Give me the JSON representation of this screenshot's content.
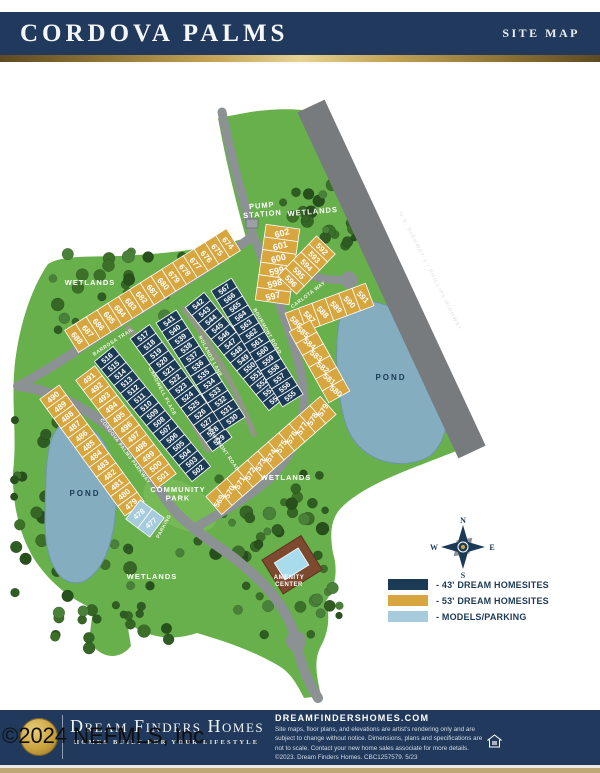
{
  "header": {
    "title": "CORDOVA PALMS",
    "right_label": "SITE MAP"
  },
  "legend": {
    "items": [
      {
        "label": "-  43' DREAM HOMESITES",
        "color": "#1b3a55"
      },
      {
        "label": "-  53' DREAM HOMESITES",
        "color": "#d8a63f"
      },
      {
        "label": "-  MODELS/PARKING",
        "color": "#a6cbdd"
      }
    ]
  },
  "compass": {
    "n": "N",
    "e": "E",
    "s": "S",
    "w": "W"
  },
  "map": {
    "colors": {
      "green": "#68b04c",
      "parkGreen": "#79bd58",
      "pond": "#84adc0",
      "pondEdge": "#6d96aa",
      "highway": "#777b7e",
      "road": "#8c9194",
      "lane": "#8e9883",
      "navy": "#1b3a55",
      "gold": "#d8a63f",
      "blue": "#a6cbdd",
      "lotStroke": "#ffffff"
    },
    "strips": [
      {
        "group": "navy",
        "numbers": [
          516,
          515,
          514,
          513,
          512,
          511,
          510,
          509,
          508,
          507,
          506,
          505,
          504,
          503,
          502
        ],
        "x1": 107,
        "y1": 358,
        "x2": 198,
        "y2": 470,
        "depth": 24,
        "numRot": -40,
        "fs": 7.5
      },
      {
        "group": "navy",
        "numbers": [
          517,
          518,
          519,
          520,
          521,
          522,
          523,
          524,
          525,
          526,
          527,
          528,
          529
        ],
        "x1": 143,
        "y1": 336,
        "x2": 219,
        "y2": 440,
        "depth": 24,
        "numRot": -40,
        "fs": 7.5
      },
      {
        "group": "navy",
        "numbers": [
          541,
          540,
          539,
          538,
          537,
          536,
          535,
          534,
          533,
          532,
          531,
          530
        ],
        "x1": 169,
        "y1": 321,
        "x2": 232,
        "y2": 419,
        "depth": 24,
        "numRot": -40,
        "fs": 7.5
      },
      {
        "group": "navy",
        "numbers": [
          542,
          543,
          544,
          545,
          546,
          547,
          548,
          549,
          550,
          551,
          552,
          553,
          554
        ],
        "x1": 198,
        "y1": 304,
        "x2": 275,
        "y2": 399,
        "depth": 24,
        "numRot": -40,
        "fs": 7.5
      },
      {
        "group": "navy",
        "numbers": [
          567,
          566,
          565,
          564,
          563,
          562,
          561,
          560,
          559,
          558,
          557,
          556,
          555
        ],
        "x1": 224,
        "y1": 289,
        "x2": 290,
        "y2": 396,
        "depth": 24,
        "numRot": -40,
        "fs": 7.5
      },
      {
        "group": "gold",
        "numbers": [
          674,
          675,
          676,
          677,
          678,
          679,
          680,
          681,
          682,
          683,
          684,
          685,
          686,
          687,
          688
        ],
        "x1": 228,
        "y1": 243,
        "x2": 77,
        "y2": 338,
        "depth": 26,
        "numRot": 48,
        "fs": 8
      },
      {
        "group": "gold",
        "numbers": [
          602,
          601,
          600,
          599,
          598,
          597
        ],
        "x1": 282,
        "y1": 233,
        "x2": 273,
        "y2": 296,
        "depth": 34,
        "numRot": -15,
        "fs": 9
      },
      {
        "group": "gold",
        "numbers": [
          592,
          593,
          594,
          595,
          596
        ],
        "x1": 322,
        "y1": 249,
        "x2": 291,
        "y2": 281,
        "depth": 26,
        "numRot": 45,
        "fs": 8
      },
      {
        "group": "gold",
        "numbers": [
          586,
          587,
          588,
          589,
          590,
          591
        ],
        "x1": 296,
        "y1": 322,
        "x2": 363,
        "y2": 297,
        "depth": 24,
        "numRot": 45,
        "fs": 8
      },
      {
        "group": "gold",
        "numbers": [
          585,
          584,
          583,
          582,
          581,
          580
        ],
        "x1": 303,
        "y1": 332,
        "x2": 336,
        "y2": 391,
        "depth": 24,
        "numRot": 38,
        "fs": 8
      },
      {
        "group": "gold",
        "numbers": [
          579,
          578,
          577,
          576,
          575,
          574,
          573,
          572,
          571,
          570,
          569
        ],
        "x1": 323,
        "y1": 410,
        "x2": 219,
        "y2": 501,
        "depth": 24,
        "numRot": -60,
        "fs": 8
      },
      {
        "group": "gold",
        "numbers": [
          491,
          492,
          493,
          494,
          495,
          496,
          497,
          498,
          499,
          500,
          501
        ],
        "x1": 89,
        "y1": 378,
        "x2": 163,
        "y2": 476,
        "depth": 24,
        "numRot": -40,
        "fs": 8
      },
      {
        "group": "gold",
        "numbers": [
          490,
          489,
          488,
          487,
          486,
          485,
          484,
          483,
          482,
          481,
          480,
          479
        ],
        "x1": 53,
        "y1": 397,
        "x2": 131,
        "y2": 504,
        "depth": 24,
        "numRot": -40,
        "fs": 8
      },
      {
        "group": "blue",
        "numbers": [
          478,
          477
        ],
        "x1": 139,
        "y1": 514,
        "x2": 151,
        "y2": 523,
        "depth": 24,
        "numRot": -40,
        "fs": 7.5
      }
    ],
    "labels": [
      {
        "text": "WETLANDS",
        "x": 90,
        "y": 285,
        "rot": 0,
        "cls": "area"
      },
      {
        "text": "WETLANDS",
        "x": 313,
        "y": 214,
        "rot": -5,
        "cls": "area"
      },
      {
        "text": "WETLANDS",
        "x": 286,
        "y": 480,
        "rot": 0,
        "cls": "area"
      },
      {
        "text": "WETLANDS",
        "x": 152,
        "y": 579,
        "rot": 0,
        "cls": "area"
      },
      {
        "lines": [
          "PUMP",
          "STATION"
        ],
        "x": 262,
        "y": 208,
        "rot": -5,
        "cls": "area"
      },
      {
        "lines": [
          "COMMUNITY",
          "PARK"
        ],
        "x": 178,
        "y": 492,
        "rot": 0,
        "cls": "area"
      },
      {
        "lines": [
          "AMENITY",
          "CENTER"
        ],
        "x": 289,
        "y": 579,
        "rot": 0,
        "cls": "amenity"
      },
      {
        "text": "POND",
        "x": 85,
        "y": 496,
        "rot": 0,
        "cls": "pond"
      },
      {
        "text": "POND",
        "x": 391,
        "y": 380,
        "rot": 0,
        "cls": "pond"
      },
      {
        "text": "PARKING",
        "x": 165,
        "y": 527,
        "rot": -62,
        "cls": "street"
      },
      {
        "text": "BARROSA TRAIL",
        "x": 114,
        "y": 343,
        "rot": -33,
        "cls": "street"
      },
      {
        "text": "CORDOVA PALMS PARKWAY",
        "x": 124,
        "y": 452,
        "rot": 53,
        "cls": "street"
      },
      {
        "text": "CARDWELL PLACE",
        "x": 161,
        "y": 392,
        "rot": 62,
        "cls": "street"
      },
      {
        "text": "ROLANDS LANE",
        "x": 209,
        "y": 357,
        "rot": 62,
        "cls": "street"
      },
      {
        "text": "BOURMONT ROAD",
        "x": 266,
        "y": 332,
        "rot": 60,
        "cls": "street"
      },
      {
        "text": "BOURMONT ROAD",
        "x": 222,
        "y": 450,
        "rot": 55,
        "cls": "street"
      },
      {
        "text": "CARLOTA WAY",
        "x": 309,
        "y": 296,
        "rot": -37,
        "cls": "street"
      },
      {
        "text": "U.S. HIGHWAY 1 / PHILLIPS HIGHWAY",
        "x": 429,
        "y": 272,
        "rot": 63,
        "cls": "hwy"
      },
      {
        "text": "N",
        "x": 463,
        "y": 523,
        "rot": 0,
        "cls": "compass"
      },
      {
        "text": "W",
        "x": 434,
        "y": 550,
        "rot": 0,
        "cls": "compass"
      },
      {
        "text": "E",
        "x": 492,
        "y": 550,
        "rot": 0,
        "cls": "compass"
      },
      {
        "text": "S",
        "x": 463,
        "y": 578,
        "rot": 0,
        "cls": "compass"
      }
    ]
  },
  "footer": {
    "brand": "Dream Finders Homes",
    "tagline": "HOMES BUILT FOR YOUR LIFESTYLE",
    "website": "DREAMFINDERSHOMES.COM",
    "disclaimer": "Site maps, floor plans, and elevations are artist's rendering only and are subject to change without notice. Dimensions, plans and specifications are not to scale. Contact your new home sales associate for more details. ©2023. Dream Finders Homes. CBC1257579.  5/23"
  },
  "watermark": {
    "text": "©2024 NEFMLS, Inc"
  }
}
